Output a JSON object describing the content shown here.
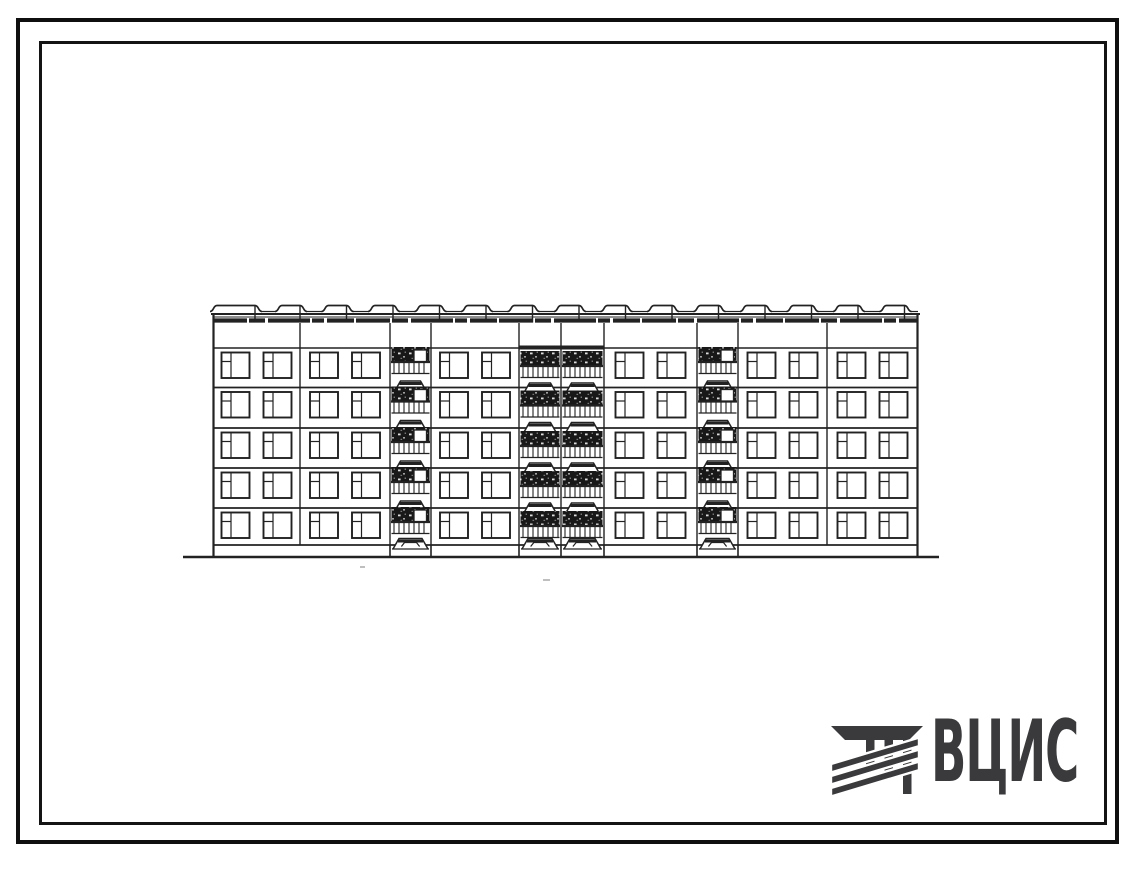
{
  "page": {
    "background": "#ffffff",
    "frame_color": "#0f0f0f"
  },
  "logo": {
    "text": "ВЦИС",
    "color": "#3a3a3c"
  },
  "drawing": {
    "ink": "#222222",
    "dark_fill": "#181818",
    "building": {
      "left": 213,
      "right": 918,
      "roof_line_y": 314,
      "parapet_low_y": 311.5,
      "parapet_top_y": 305.5,
      "cornice_thin_y": 317,
      "cornice_band_y": 320.5,
      "attic_bottom_y": 348,
      "attic_dark_segment": {
        "x1": 519,
        "x2": 604
      },
      "floor_lines": [
        387.5,
        428,
        468,
        508
      ],
      "floor_tops": [
        348,
        387.5,
        428,
        468,
        508
      ],
      "window_rows": [
        352.5,
        392,
        432.5,
        472.5,
        512.5
      ],
      "window": {
        "width": 28,
        "height": 25.5,
        "pair_gap": 14,
        "sash_x": 9.5,
        "vent_y": 9
      },
      "plinth_y": 545,
      "ground_y": 557,
      "ground_line": {
        "x1": 183,
        "x2": 939
      },
      "parapet_bumps": {
        "first": {
          "s": 217,
          "e": 255
        },
        "start": 282,
        "plateau": 18,
        "period": 46.5,
        "count": 14
      },
      "sections": [
        {
          "kind": "windows",
          "x1": 213,
          "x2": 300
        },
        {
          "kind": "windows",
          "x1": 300,
          "x2": 390
        },
        {
          "kind": "loggia",
          "x1": 390,
          "x2": 431,
          "door": true,
          "shift": -4
        },
        {
          "kind": "windows",
          "x1": 431,
          "x2": 519
        },
        {
          "kind": "loggia",
          "x1": 519,
          "x2": 561,
          "door": false,
          "shift": 0
        },
        {
          "kind": "loggia",
          "x1": 561,
          "x2": 604,
          "door": false,
          "shift": 0
        },
        {
          "kind": "windows",
          "x1": 604,
          "x2": 697
        },
        {
          "kind": "loggia",
          "x1": 697,
          "x2": 738,
          "door": true,
          "shift": -4
        },
        {
          "kind": "windows",
          "x1": 738,
          "x2": 827
        },
        {
          "kind": "windows",
          "x1": 827,
          "x2": 918
        }
      ],
      "joints": [
        300,
        390,
        431,
        519,
        561,
        604,
        697,
        738,
        827
      ],
      "porch_columns": [
        390,
        431,
        519,
        561,
        604,
        697,
        738
      ],
      "canopy_y": 537
    },
    "stray_marks": [
      {
        "x": 543,
        "y": 579,
        "w": 7,
        "h": 2
      },
      {
        "x": 360,
        "y": 566,
        "w": 5,
        "h": 2
      }
    ]
  }
}
